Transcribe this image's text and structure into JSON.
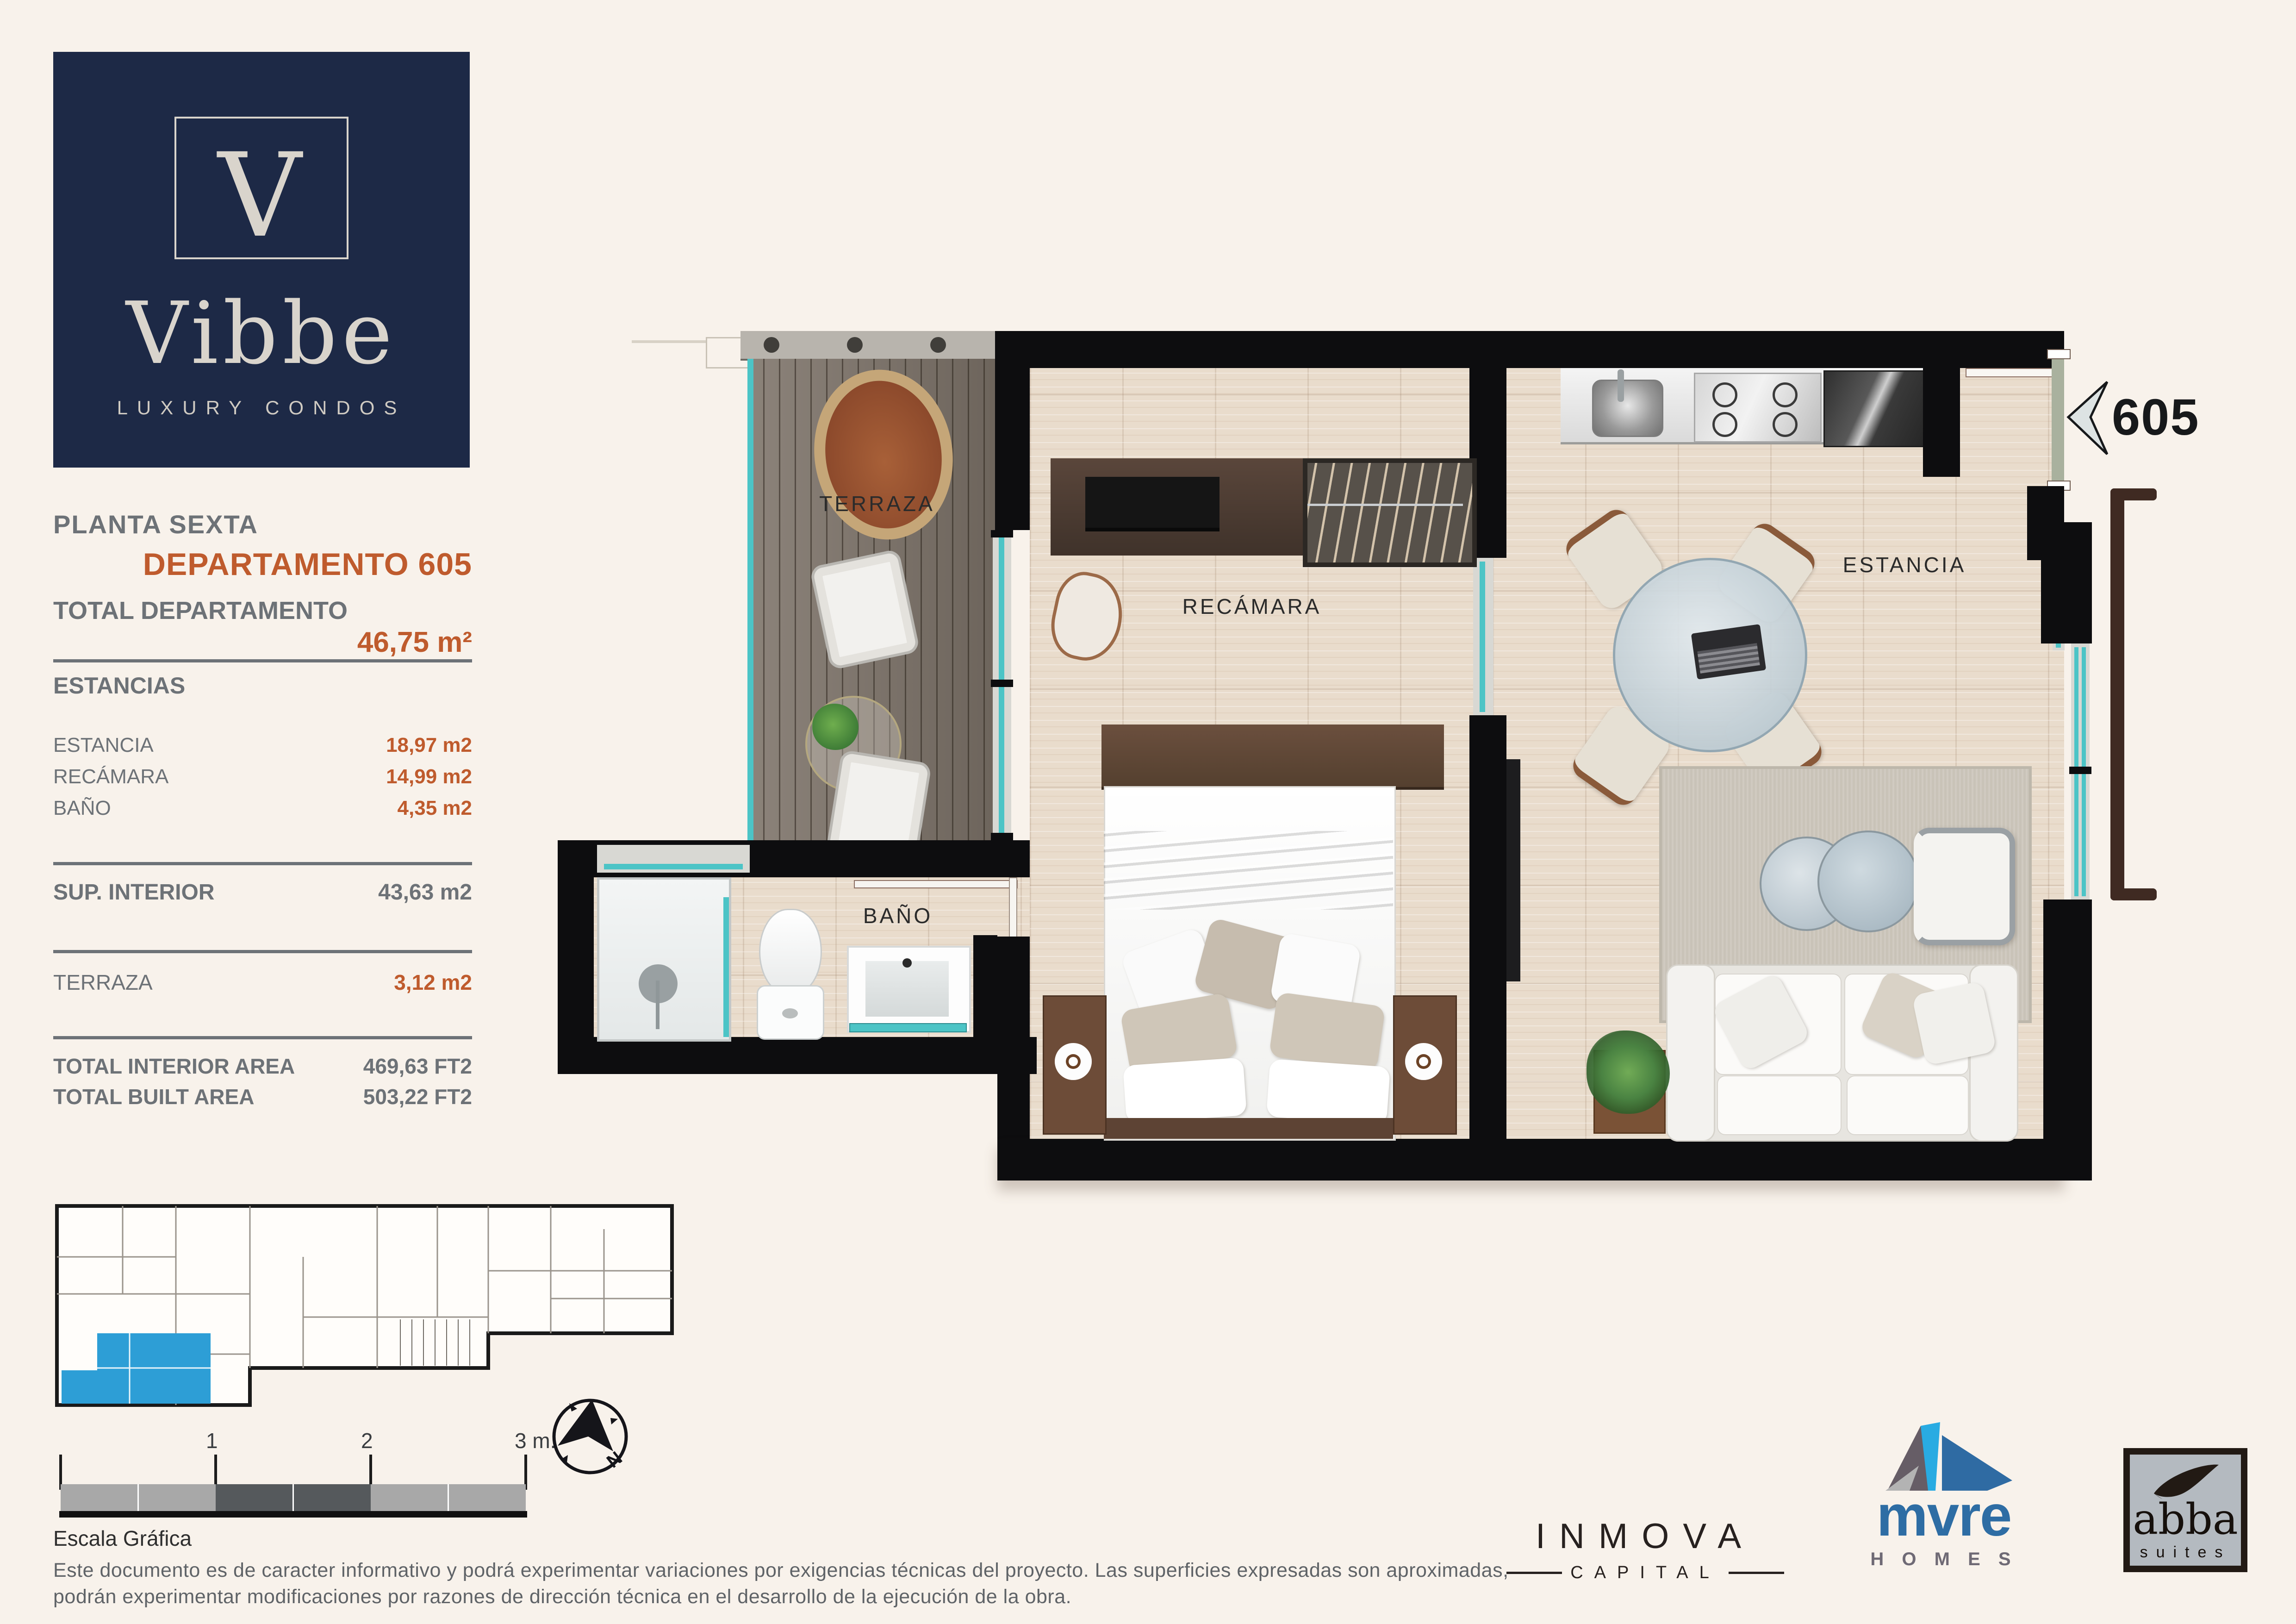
{
  "brand": {
    "monogram": "V",
    "name": "Vibbe",
    "tagline": "LUXURY CONDOS"
  },
  "header": {
    "floor_label": "PLANTA SEXTA",
    "unit_label": "DEPARTAMENTO 605"
  },
  "totals": {
    "total_dept_label": "TOTAL DEPARTAMENTO",
    "total_dept_value": "46,75 m²",
    "estancias_label": "ESTANCIAS",
    "rows": [
      {
        "label": "ESTANCIA",
        "value": "18,97 m2"
      },
      {
        "label": "RECÁMARA",
        "value": "14,99 m2"
      },
      {
        "label": "BAÑO",
        "value": "4,35 m2"
      }
    ],
    "sup_interior_label": "SUP. INTERIOR",
    "sup_interior_value": "43,63 m2",
    "terraza_label": "TERRAZA",
    "terraza_value": "3,12 m2",
    "total_interior_label": "TOTAL INTERIOR AREA",
    "total_interior_value": "469,63 FT2",
    "total_built_label": "TOTAL BUILT AREA",
    "total_built_value": "503,22 FT2"
  },
  "plan": {
    "labels": {
      "terraza": "TERRAZA",
      "recamara": "RECÁMARA",
      "bano": "BAÑO",
      "estancia": "ESTANCIA"
    },
    "unit_marker": "605"
  },
  "scale_bar": {
    "tick1": "1",
    "tick2": "2",
    "tick3": "3 m.",
    "caption": "Escala Gráfica"
  },
  "compass": {
    "north_label": "N"
  },
  "disclaimer": {
    "line1": "Este documento es de caracter informativo y podrá experimentar variaciones por exigencias técnicas del proyecto. Las superficies expresadas son aproximadas,",
    "line2": "podrán experimentar modificaciones por razones de dirección técnica en el desarrollo de la ejecución de la obra."
  },
  "footer_logos": {
    "inmova": {
      "name": "INMOVA",
      "sub": "CAPITAL"
    },
    "mvre": {
      "name": "mvre",
      "sub": "H O M E S"
    },
    "abba": {
      "name": "abba",
      "sub": "suites"
    }
  },
  "colors": {
    "navy": "#1d2946",
    "orange": "#bf5b2d",
    "gray_text": "#6d7277",
    "teal_glass": "#4cc4c6",
    "keyplan_highlight": "#2d9ed6",
    "wall_black": "#0d0d0f"
  }
}
